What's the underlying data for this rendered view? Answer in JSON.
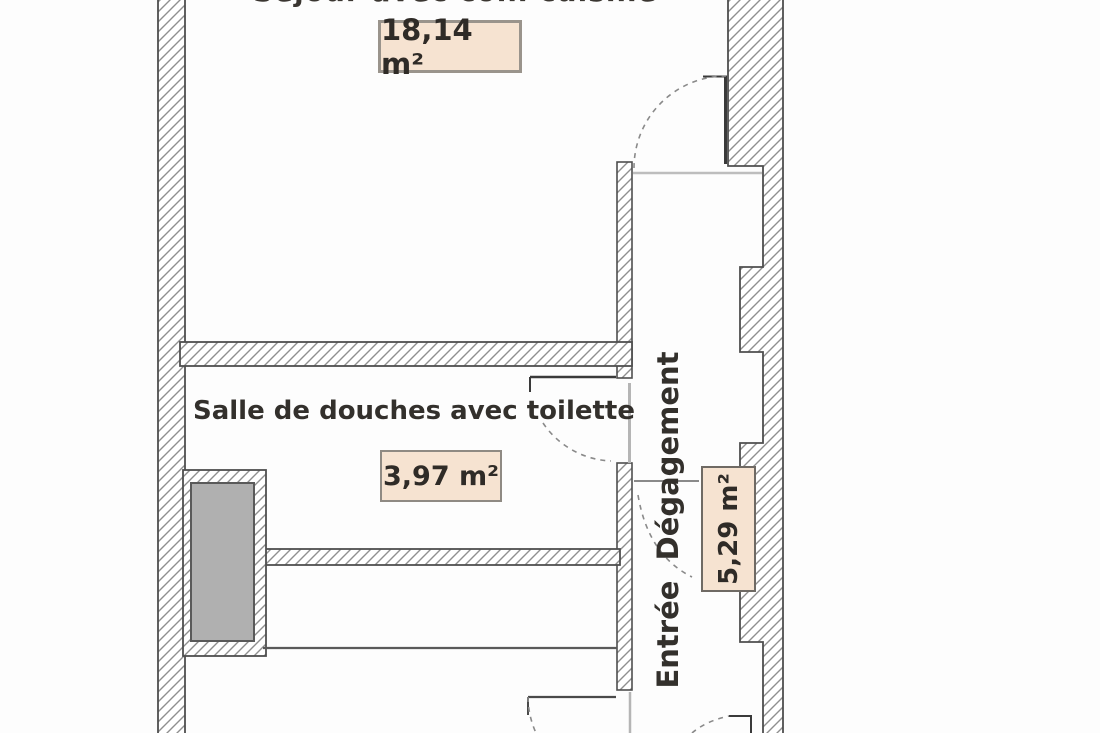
{
  "floorplan": {
    "top_label_partial": "Séjour avec coin cuisine",
    "living": {
      "area": "18,14 m²"
    },
    "shower_room": {
      "label": "Salle de douches avec toilette",
      "area": "3,97 m²"
    },
    "hallway": {
      "label": "Entrée  Dégagement",
      "area": "5,29 m²"
    },
    "colors": {
      "label_fill": "#f6e3d1",
      "label_border": "#9a948c",
      "hatch_line": "#8f8f8f",
      "wall_outline": "#4f4f4f",
      "duct_fill": "#b0b0b0",
      "text": "#2f2b27"
    }
  }
}
